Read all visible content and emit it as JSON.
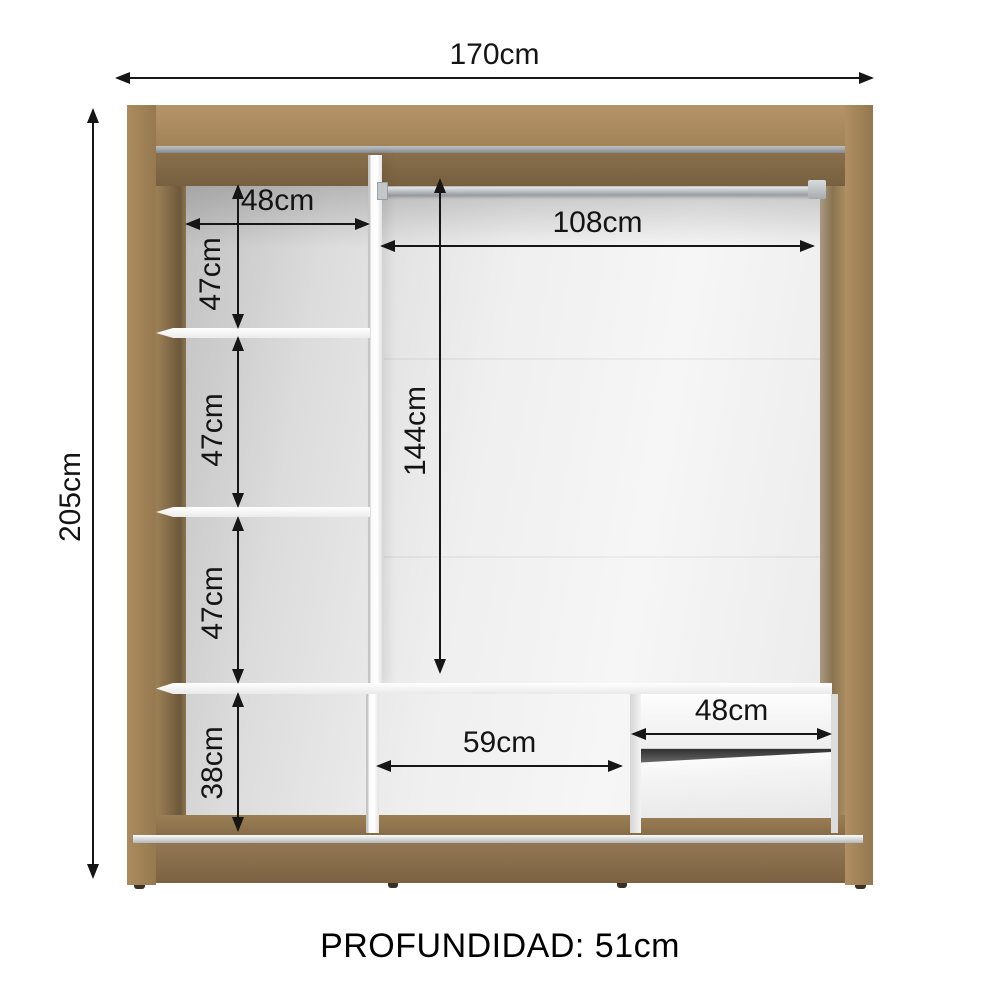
{
  "diagram": {
    "subject": "wardrobe-internal-dimensions",
    "depth_label": "PROFUNDIDAD: 51cm",
    "dimensions": {
      "total_width": "170cm",
      "total_height": "205cm",
      "left_column_width": "48cm",
      "left_section_1_height": "47cm",
      "left_section_2_height": "47cm",
      "left_section_3_height": "47cm",
      "left_bottom_height": "38cm",
      "rod_span_width": "108cm",
      "hanging_height": "144cm",
      "bottom_middle_width": "59cm",
      "drawer_width": "48cm"
    },
    "colors": {
      "wood_light": "#ab8c60",
      "wood_dark": "#7f6849",
      "interior_light": "#f6f6f6",
      "interior_shadow": "#c3c3c3",
      "dimension_line": "#161616",
      "rod_metal": "#9aa0a4"
    }
  }
}
